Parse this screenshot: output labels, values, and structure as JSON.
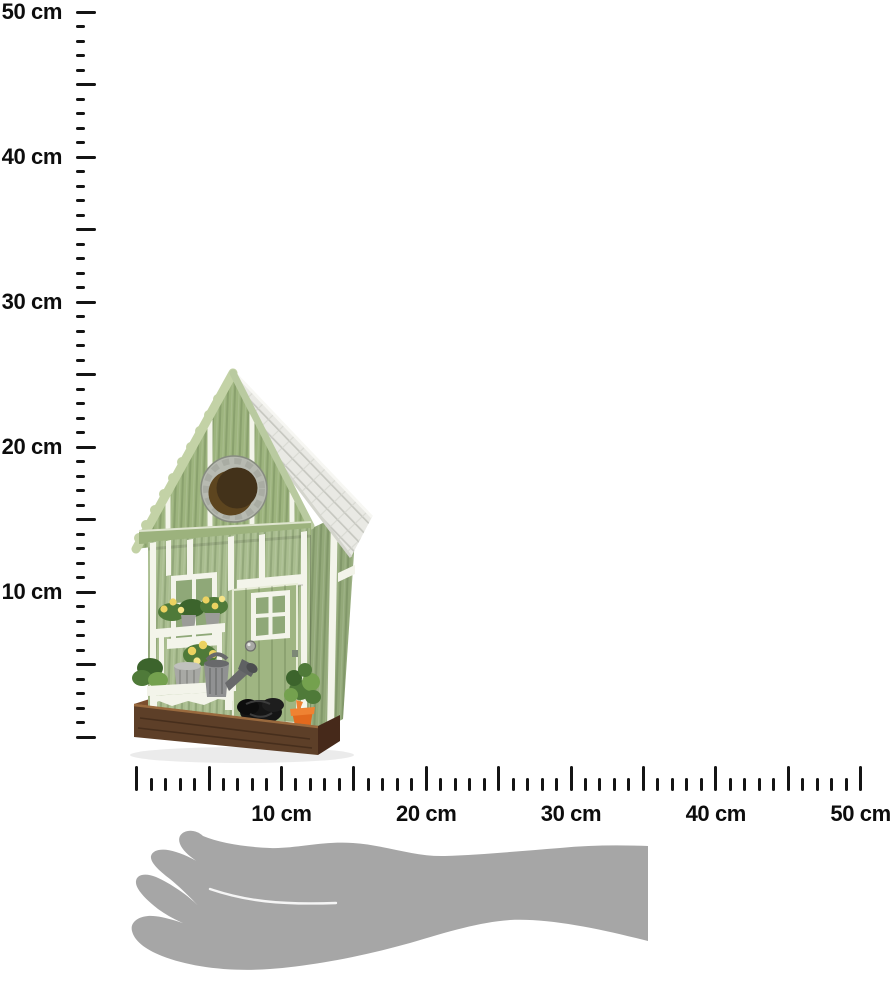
{
  "page": {
    "background": "#ffffff"
  },
  "vertical_ruler": {
    "unit": "cm",
    "min": 0,
    "max": 50,
    "minor_step": 1,
    "major_step": 5,
    "labels": [
      {
        "value": 50,
        "text": "50 cm"
      },
      {
        "value": 40,
        "text": "40 cm"
      },
      {
        "value": 30,
        "text": "30 cm"
      },
      {
        "value": 20,
        "text": "20 cm"
      },
      {
        "value": 10,
        "text": "10 cm"
      }
    ],
    "tick_color": "#141414",
    "label_color": "#0d0d0d"
  },
  "horizontal_ruler": {
    "unit": "cm",
    "min": 0,
    "max": 50,
    "minor_step": 1,
    "major_step": 5,
    "labels": [
      {
        "value": 10,
        "text": "10 cm"
      },
      {
        "value": 20,
        "text": "20 cm"
      },
      {
        "value": 30,
        "text": "30 cm"
      },
      {
        "value": 40,
        "text": "40 cm"
      },
      {
        "value": 50,
        "text": "50 cm"
      }
    ],
    "tick_color": "#141414",
    "label_color": "#0d0d0d"
  },
  "product": {
    "label": "green-garden-shed-birdhouse",
    "colors": {
      "facade_green": "#a9bd8f",
      "gable_green": "#9db47e",
      "side_green": "#93a979",
      "beam_green": "#9cb27d",
      "scallop_green": "#c3d2a6",
      "trim_white": "#f3f4ea",
      "roof_white": "#e9e9e4",
      "roof_edge": "#d4d5cd",
      "window_glass": "#8fa878",
      "door_green": "#9fb582",
      "hole_rim": "#b7bab1",
      "hole_dark": "#43321a",
      "hole_mid": "#5d451f",
      "base_brown": "#5d3f28",
      "base_brown_dark": "#46291a",
      "base_top_brown": "#7b4f2e",
      "pot_gray": "#9b9c98",
      "bucket_gray": "#a8a9a5",
      "flower_yellow": "#ecd261",
      "flower_light": "#f6e488",
      "foliage_green": "#4f7a39",
      "foliage_dark": "#3c642c",
      "foliage_light": "#74a14e",
      "can_silver": "#909192",
      "can_dark": "#68696b",
      "hose_black": "#151515",
      "terracotta_orange": "#e2691d",
      "terracotta_light": "#ef8232"
    }
  },
  "hand": {
    "color": "#a6a6a6",
    "crease": "#f5f5f5"
  }
}
